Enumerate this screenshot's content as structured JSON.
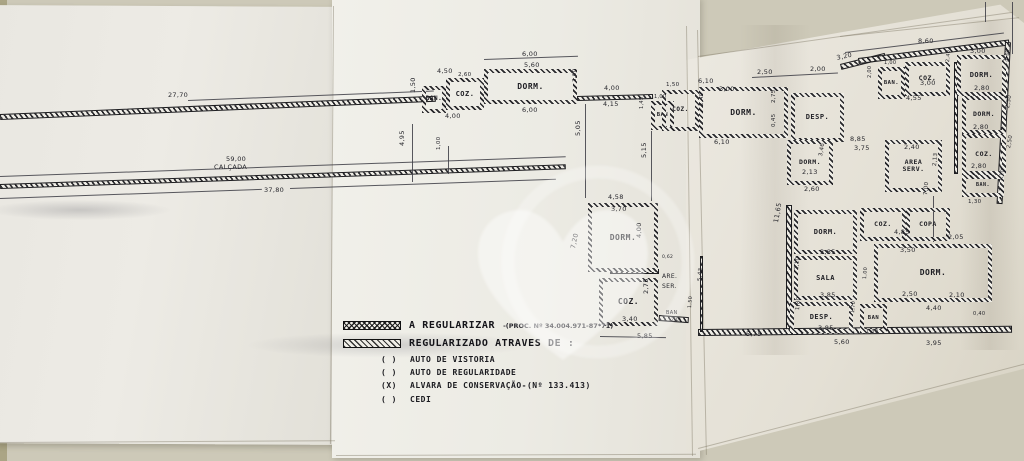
{
  "legend": {
    "row1_label": "A REGULARIZAR",
    "row1_suffix": "-(PROC. Nº 34.004.971-87*71)",
    "row2_label": "REGULARIZADO ATRAVES DE :",
    "checklist": [
      {
        "mark": "(  )",
        "label": "AUTO DE VISTORIA"
      },
      {
        "mark": "(  )",
        "label": "AUTO DE REGULARIDADE"
      },
      {
        "mark": "(X)",
        "label": "ALVARA DE CONSERVAÇÃO-(Nº 133.413)"
      },
      {
        "mark": "(  )",
        "label": "CEDI"
      }
    ]
  },
  "colors": {
    "paper": "#edebe5",
    "ink": "#26262a",
    "background": "#cdc9b8"
  },
  "diagram": {
    "creases": [
      {
        "x": 333,
        "y": 6,
        "w": 1,
        "h": 438,
        "r": 0.4
      },
      {
        "x": 686,
        "y": 26,
        "w": 1,
        "h": 430,
        "r": -0.8
      },
      {
        "x": 697,
        "y": 30,
        "w": 1,
        "h": 425,
        "r": -1.2
      },
      {
        "x": 698,
        "y": 56,
        "w": 318,
        "h": 1,
        "r": -8
      },
      {
        "x": 840,
        "y": 36,
        "w": 180,
        "h": 1,
        "r": -6
      },
      {
        "x": 698,
        "y": 448,
        "w": 340,
        "h": 1,
        "r": -14.5
      },
      {
        "x": 0,
        "y": 442,
        "w": 335,
        "h": 1,
        "r": -0.3
      },
      {
        "x": 336,
        "y": 455,
        "w": 360,
        "h": 1,
        "r": -0.2
      }
    ],
    "walls": [
      {
        "x": 0,
        "y": 114,
        "w": 436,
        "h": 6,
        "r": -2.4
      },
      {
        "x": 0,
        "y": 184,
        "w": 566,
        "h": 5,
        "r": -2.0
      },
      {
        "x": 577,
        "y": 96,
        "w": 76,
        "h": 5,
        "r": -1.5
      },
      {
        "x": 610,
        "y": 269,
        "w": 49,
        "h": 5
      },
      {
        "x": 659,
        "y": 315,
        "w": 30,
        "h": 6,
        "r": 4
      },
      {
        "x": 840,
        "y": 64,
        "w": 46,
        "h": 6,
        "r": -14
      },
      {
        "x": 858,
        "y": 58,
        "w": 152,
        "h": 6,
        "r": -7
      },
      {
        "x": 1005,
        "y": 42,
        "w": 6,
        "h": 162,
        "r": 3
      },
      {
        "x": 786,
        "y": 205,
        "w": 6,
        "h": 128
      },
      {
        "x": 698,
        "y": 329,
        "w": 314,
        "h": 7,
        "r": -0.6
      },
      {
        "x": 700,
        "y": 256,
        "w": 3,
        "h": 76
      },
      {
        "x": 954,
        "y": 62,
        "w": 4,
        "h": 112
      }
    ],
    "lines": [
      {
        "x": 0,
        "y": 176,
        "w": 566,
        "h": 1,
        "r": -2.0
      },
      {
        "x": 0,
        "y": 198,
        "w": 262,
        "h": 1,
        "r": -2.0
      },
      {
        "x": 290,
        "y": 188,
        "w": 266,
        "h": 1,
        "r": -2.0
      },
      {
        "x": 188,
        "y": 100,
        "w": 246,
        "h": 1,
        "r": -2.2
      },
      {
        "x": 585,
        "y": 104,
        "w": 1,
        "h": 94
      },
      {
        "x": 651,
        "y": 131,
        "w": 1,
        "h": 70
      },
      {
        "x": 412,
        "y": 124,
        "w": 1,
        "h": 58
      },
      {
        "x": 448,
        "y": 146,
        "w": 1,
        "h": 28
      },
      {
        "x": 484,
        "y": 59,
        "w": 94,
        "h": 1,
        "r": -2
      },
      {
        "x": 845,
        "y": 52,
        "w": 160,
        "h": 1,
        "r": -7
      },
      {
        "x": 752,
        "y": 77,
        "w": 86,
        "h": 1,
        "r": -3
      },
      {
        "x": 933,
        "y": 196,
        "w": 1,
        "h": 46
      },
      {
        "x": 1012,
        "y": 2,
        "w": 1,
        "h": 52
      },
      {
        "x": 985,
        "y": 2,
        "w": 1,
        "h": 20
      },
      {
        "x": 600,
        "y": 336,
        "w": 66,
        "h": 1,
        "r": 1
      }
    ],
    "rooms": [
      {
        "label": "BAN.",
        "x": 422,
        "y": 86,
        "w": 24,
        "h": 27,
        "fs": 6
      },
      {
        "label": "COZ.",
        "x": 446,
        "y": 78,
        "w": 38,
        "h": 32,
        "fs": 7
      },
      {
        "label": "DORM.",
        "x": 484,
        "y": 69,
        "w": 93,
        "h": 35,
        "fs": 8
      },
      {
        "label": "BAN",
        "x": 651,
        "y": 101,
        "w": 23,
        "h": 29,
        "fs": 5.5
      },
      {
        "label": "DORM.",
        "x": 588,
        "y": 203,
        "w": 70,
        "h": 69,
        "fs": 8
      },
      {
        "label": "COZ.",
        "x": 599,
        "y": 278,
        "w": 59,
        "h": 48,
        "fs": 8
      },
      {
        "label": "COZ.",
        "x": 662,
        "y": 90,
        "w": 37,
        "h": 41,
        "fs": 6
      },
      {
        "label": "DORM.",
        "x": 699,
        "y": 87,
        "w": 89,
        "h": 51,
        "fs": 8
      },
      {
        "label": "DESP.",
        "x": 791,
        "y": 93,
        "w": 53,
        "h": 49,
        "fs": 7
      },
      {
        "label": "BAN.",
        "x": 878,
        "y": 67,
        "w": 27,
        "h": 32,
        "fs": 5.5
      },
      {
        "label": "COZ.",
        "x": 905,
        "y": 62,
        "w": 45,
        "h": 34,
        "fs": 6.5
      },
      {
        "label": "DORM.",
        "x": 957,
        "y": 55,
        "w": 49,
        "h": 41,
        "fs": 7
      },
      {
        "label": "DORM.",
        "x": 962,
        "y": 96,
        "w": 44,
        "h": 38,
        "fs": 6.5
      },
      {
        "label": "COZ.",
        "x": 962,
        "y": 134,
        "w": 44,
        "h": 41,
        "fs": 6.5
      },
      {
        "label": "BAN.",
        "x": 962,
        "y": 175,
        "w": 42,
        "h": 22,
        "fs": 5
      },
      {
        "label": "DORM.",
        "x": 787,
        "y": 140,
        "w": 46,
        "h": 45,
        "fs": 6.5
      },
      {
        "label": "AREA\nSERV.",
        "x": 885,
        "y": 140,
        "w": 57,
        "h": 52,
        "fs": 6.5
      },
      {
        "label": "DORM.",
        "x": 794,
        "y": 210,
        "w": 63,
        "h": 44,
        "fs": 7
      },
      {
        "label": "COZ.",
        "x": 860,
        "y": 208,
        "w": 46,
        "h": 33,
        "fs": 6.5
      },
      {
        "label": "COPA",
        "x": 906,
        "y": 208,
        "w": 44,
        "h": 33,
        "fs": 6.5
      },
      {
        "label": "DORM.",
        "x": 874,
        "y": 244,
        "w": 118,
        "h": 58,
        "fs": 8
      },
      {
        "label": "SALA",
        "x": 794,
        "y": 256,
        "w": 63,
        "h": 44,
        "fs": 7
      },
      {
        "label": "DESP.",
        "x": 790,
        "y": 302,
        "w": 63,
        "h": 31,
        "fs": 7
      },
      {
        "label": "BAN",
        "x": 860,
        "y": 304,
        "w": 27,
        "h": 29,
        "fs": 5.5
      }
    ],
    "dims": [
      {
        "t": "27,70",
        "x": 168,
        "y": 92
      },
      {
        "t": "59,00",
        "x": 226,
        "y": 156
      },
      {
        "t": "CALÇADA",
        "x": 214,
        "y": 164
      },
      {
        "t": "37,80",
        "x": 264,
        "y": 187
      },
      {
        "t": "6,00",
        "x": 522,
        "y": 51
      },
      {
        "t": "5,60",
        "x": 524,
        "y": 62
      },
      {
        "t": "4,50",
        "x": 437,
        "y": 68
      },
      {
        "t": "2,60",
        "x": 458,
        "y": 73,
        "fs": 5.5
      },
      {
        "t": "1,50",
        "x": 410,
        "y": 93,
        "r": -90
      },
      {
        "t": "4,00",
        "x": 445,
        "y": 113
      },
      {
        "t": "6,00",
        "x": 522,
        "y": 107
      },
      {
        "t": "3,00",
        "x": 573,
        "y": 82,
        "r": -90,
        "fs": 5.5
      },
      {
        "t": "4,95",
        "x": 399,
        "y": 146,
        "r": -90
      },
      {
        "t": "1,00",
        "x": 437,
        "y": 150,
        "r": -90,
        "fs": 5.5
      },
      {
        "t": "4,00",
        "x": 604,
        "y": 85
      },
      {
        "t": "4,15",
        "x": 603,
        "y": 101
      },
      {
        "t": "1,00",
        "x": 654,
        "y": 95,
        "fs": 5
      },
      {
        "t": "1,45",
        "x": 640,
        "y": 109,
        "r": -90,
        "fs": 5
      },
      {
        "t": "5,05",
        "x": 575,
        "y": 136,
        "r": -90
      },
      {
        "t": "5,15",
        "x": 641,
        "y": 158,
        "r": -90
      },
      {
        "t": "4,58",
        "x": 608,
        "y": 194
      },
      {
        "t": "3,70",
        "x": 611,
        "y": 206
      },
      {
        "t": "7,20",
        "x": 570,
        "y": 248,
        "r": -78
      },
      {
        "t": "4,00",
        "x": 636,
        "y": 238,
        "r": -90
      },
      {
        "t": "0,62",
        "x": 662,
        "y": 256,
        "fs": 4.5
      },
      {
        "t": "ARE.",
        "x": 662,
        "y": 274,
        "fs": 6
      },
      {
        "t": "SER.",
        "x": 662,
        "y": 284,
        "fs": 6
      },
      {
        "t": "2,75",
        "x": 643,
        "y": 294,
        "r": -90
      },
      {
        "t": "3,40",
        "x": 622,
        "y": 316
      },
      {
        "t": "5,85",
        "x": 637,
        "y": 333
      },
      {
        "t": "BAN",
        "x": 666,
        "y": 311,
        "fs": 5
      },
      {
        "t": "2,0",
        "x": 671,
        "y": 319,
        "fs": 4.5
      },
      {
        "t": "1,50",
        "x": 666,
        "y": 83,
        "fs": 5.5
      },
      {
        "t": "6,10",
        "x": 698,
        "y": 78
      },
      {
        "t": "3,00",
        "x": 719,
        "y": 86
      },
      {
        "t": "2,40",
        "x": 700,
        "y": 106,
        "r": -90,
        "fs": 5.5
      },
      {
        "t": "6,10",
        "x": 714,
        "y": 139
      },
      {
        "t": "2,50",
        "x": 757,
        "y": 69
      },
      {
        "t": "2,00",
        "x": 810,
        "y": 66
      },
      {
        "t": "2,75",
        "x": 772,
        "y": 103,
        "r": -90,
        "fs": 5.5
      },
      {
        "t": "0,45",
        "x": 772,
        "y": 127,
        "r": -90,
        "fs": 5.5
      },
      {
        "t": "3,20",
        "x": 836,
        "y": 55,
        "r": -12
      },
      {
        "t": "8,60",
        "x": 918,
        "y": 38
      },
      {
        "t": "1,00",
        "x": 884,
        "y": 61,
        "fs": 5
      },
      {
        "t": "2,00",
        "x": 868,
        "y": 78,
        "r": -90,
        "fs": 5
      },
      {
        "t": "3,00",
        "x": 920,
        "y": 80
      },
      {
        "t": "4,55",
        "x": 906,
        "y": 95
      },
      {
        "t": "3,00",
        "x": 970,
        "y": 48
      },
      {
        "t": "2,80",
        "x": 974,
        "y": 85
      },
      {
        "t": "3,30",
        "x": 1004,
        "y": 62,
        "r": -80,
        "fs": 5.5
      },
      {
        "t": "2,40",
        "x": 946,
        "y": 62,
        "r": -85,
        "fs": 5
      },
      {
        "t": "2,80",
        "x": 973,
        "y": 124
      },
      {
        "t": "2,50",
        "x": 1006,
        "y": 108,
        "r": -80,
        "fs": 5.5
      },
      {
        "t": "2,80",
        "x": 971,
        "y": 163
      },
      {
        "t": "2,50",
        "x": 1007,
        "y": 148,
        "r": -80,
        "fs": 5.5
      },
      {
        "t": "1,30",
        "x": 968,
        "y": 200,
        "fs": 5.5
      },
      {
        "t": "1,10",
        "x": 999,
        "y": 181,
        "r": -80,
        "fs": 5
      },
      {
        "t": "8,85",
        "x": 850,
        "y": 136
      },
      {
        "t": "3,75",
        "x": 854,
        "y": 145
      },
      {
        "t": "2,40",
        "x": 904,
        "y": 144
      },
      {
        "t": "2,13",
        "x": 933,
        "y": 166,
        "r": -85,
        "fs": 5.5
      },
      {
        "t": "2,13",
        "x": 802,
        "y": 169
      },
      {
        "t": "3,46",
        "x": 819,
        "y": 156,
        "r": -80,
        "fs": 5.5
      },
      {
        "t": "2,60",
        "x": 804,
        "y": 186
      },
      {
        "t": "11,65",
        "x": 773,
        "y": 222,
        "r": -80
      },
      {
        "t": "3,85",
        "x": 820,
        "y": 249
      },
      {
        "t": "2,10",
        "x": 795,
        "y": 270,
        "r": -85,
        "fs": 5.5
      },
      {
        "t": "3,85",
        "x": 820,
        "y": 292
      },
      {
        "t": "1,80",
        "x": 796,
        "y": 310,
        "r": -85,
        "fs": 5.5
      },
      {
        "t": "3,85",
        "x": 818,
        "y": 325
      },
      {
        "t": "4,85",
        "x": 894,
        "y": 229
      },
      {
        "t": "3,50",
        "x": 900,
        "y": 247
      },
      {
        "t": "2,05",
        "x": 948,
        "y": 234
      },
      {
        "t": "2,50",
        "x": 902,
        "y": 291
      },
      {
        "t": "2,10",
        "x": 949,
        "y": 292
      },
      {
        "t": "4,40",
        "x": 926,
        "y": 305
      },
      {
        "t": "0,40",
        "x": 973,
        "y": 312,
        "fs": 5
      },
      {
        "t": "1,00",
        "x": 863,
        "y": 279,
        "r": -85,
        "fs": 5
      },
      {
        "t": "1,70",
        "x": 851,
        "y": 313,
        "r": -85,
        "fs": 5
      },
      {
        "t": "1,30",
        "x": 866,
        "y": 330,
        "fs": 5
      },
      {
        "t": "5,60",
        "x": 834,
        "y": 339
      },
      {
        "t": "3,95",
        "x": 926,
        "y": 340
      },
      {
        "t": "5,75",
        "x": 746,
        "y": 331
      },
      {
        "t": "5,43",
        "x": 698,
        "y": 281,
        "r": -85,
        "fs": 5.5
      },
      {
        "t": "1,50",
        "x": 688,
        "y": 308,
        "r": -85,
        "fs": 5
      },
      {
        "t": "7,00",
        "x": 924,
        "y": 195,
        "r": -85,
        "fs": 5.5
      }
    ]
  }
}
